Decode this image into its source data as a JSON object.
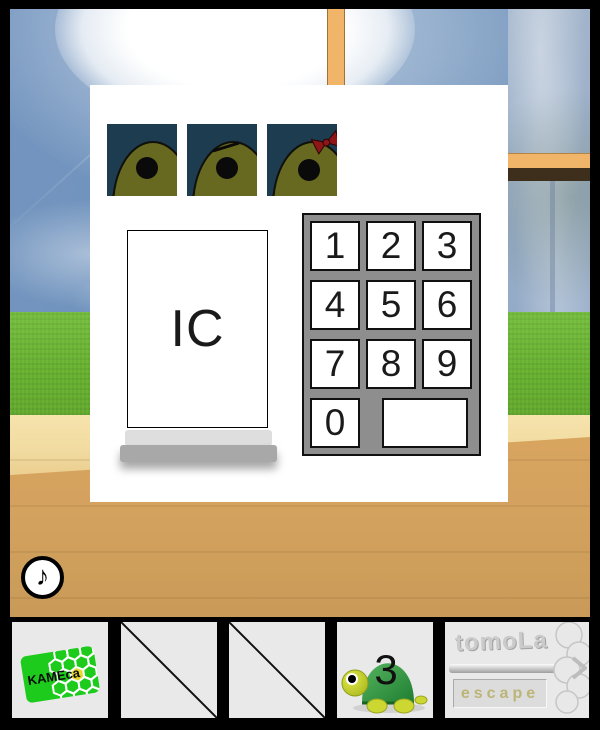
{
  "panel": {
    "ic_card_label": "IC",
    "keypad": {
      "keys": [
        "1",
        "2",
        "3",
        "4",
        "5",
        "6",
        "7",
        "8",
        "9",
        "0"
      ],
      "blank_key_label": ""
    },
    "kame_tiles": [
      {
        "variant": "plain"
      },
      {
        "variant": "eyebrow"
      },
      {
        "variant": "red-ribbon"
      }
    ]
  },
  "music_button": {
    "glyph": "♪"
  },
  "toolbar": {
    "kameca_card_label": "KAMEca",
    "turtle_number": "3",
    "brand_name": "tomoLa",
    "brand_sub": "escape"
  },
  "colors": {
    "tile_background": "#1e3c50",
    "tile_head_olive": "#66691f",
    "ribbon_red": "#8e1616",
    "keypad_gray": "#8e8e8e",
    "card_green": "#1dcb1d",
    "hex_yellow": "#e6d92e",
    "slot_gray": "#e9e9e9",
    "frame_orange": "#f0b568",
    "grass_green": "#6cb534",
    "floor_light": "#f3dfa6",
    "floor_dark": "#d9a55f"
  }
}
